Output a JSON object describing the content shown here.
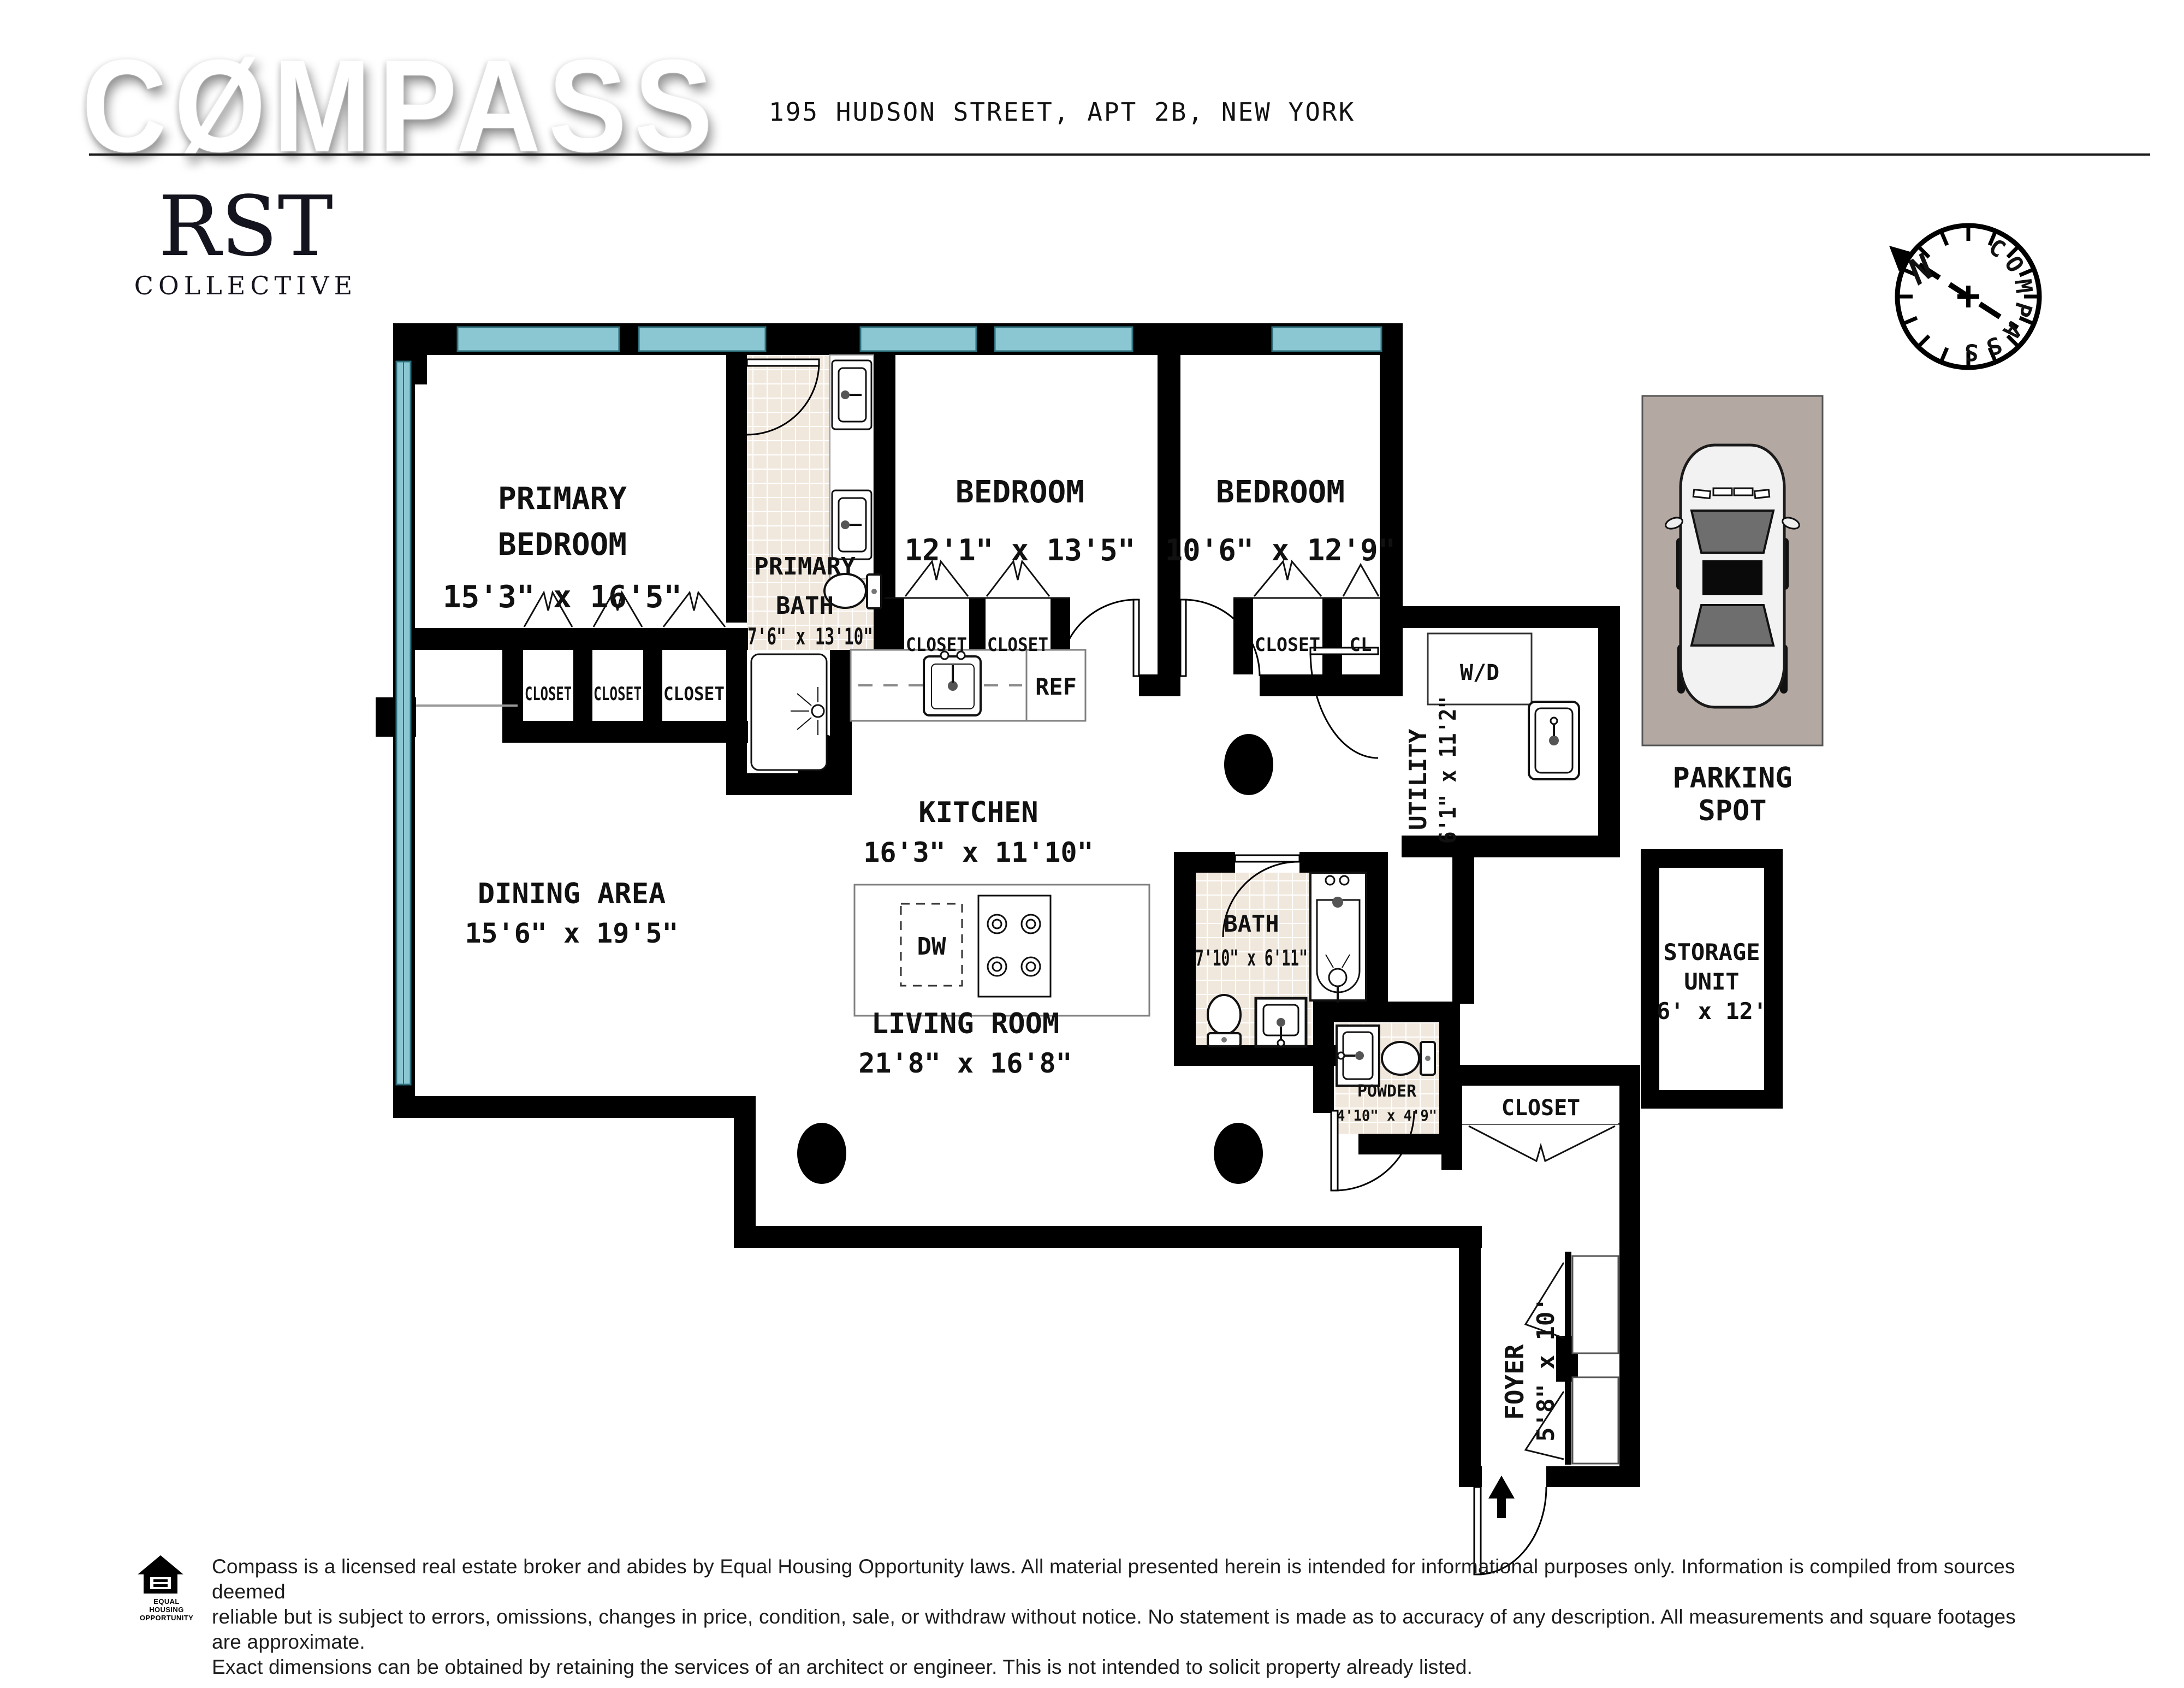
{
  "header": {
    "logo_text": "CØMPASS",
    "address": "195 HUDSON STREET, APT 2B, NEW YORK"
  },
  "brand": {
    "rst": "RST",
    "collective": "COLLECTIVE"
  },
  "compass_rose": {
    "ring_label": "COMPASS",
    "north_label": "N"
  },
  "rooms": {
    "primary_bedroom": {
      "line1": "PRIMARY",
      "line2": "BEDROOM",
      "dims": "15'3\" x 16'5\""
    },
    "primary_bath": {
      "line1": "PRIMARY",
      "line2": "BATH",
      "dims": "7'6\" x 13'10\""
    },
    "bedroom_1": {
      "name": "BEDROOM",
      "dims": "12'1\" x 13'5\""
    },
    "bedroom_2": {
      "name": "BEDROOM",
      "dims": "10'6\" x 12'9\""
    },
    "kitchen": {
      "name": "KITCHEN",
      "dims": "16'3\" x 11'10\""
    },
    "dining_area": {
      "name": "DINING AREA",
      "dims": "15'6\" x 19'5\""
    },
    "living_room": {
      "name": "LIVING ROOM",
      "dims": "21'8\" x 16'8\""
    },
    "bath": {
      "name": "BATH",
      "dims": "7'10\" x 6'11\""
    },
    "powder": {
      "name": "POWDER",
      "dims": "4'10\" x 4'9\""
    },
    "utility": {
      "name": "UTILITY",
      "dims": "6'1\" x 11'2\""
    },
    "foyer": {
      "name": "FOYER",
      "dims": "5'8\" x 10'"
    },
    "storage": {
      "line1": "STORAGE",
      "line2": "UNIT",
      "dims": "6' x 12'"
    },
    "parking": {
      "line1": "PARKING",
      "line2": "SPOT"
    }
  },
  "fixtures": {
    "closet": "CLOSET",
    "cl": "CL",
    "washer_dryer": "W/D",
    "refrigerator": "REF",
    "dishwasher": "DW"
  },
  "footer": {
    "equal_housing_line1": "EQUAL HOUSING",
    "equal_housing_line2": "OPPORTUNITY",
    "disclaimer_line1": "Compass is a licensed real estate broker and abides by Equal Housing Opportunity laws. All material presented herein is intended for informational purposes only. Information is compiled from sources deemed",
    "disclaimer_line2": "reliable but is subject to errors, omissions, changes in price, condition, sale, or withdraw without notice. No statement is made as to accuracy of any description. All measurements and square footages are approximate.",
    "disclaimer_line3": "Exact dimensions can be obtained by retaining the services of an architect or engineer. This is not intended to solicit property already listed."
  },
  "colors": {
    "window_glass": "#8bc7d2",
    "wall": "#000000",
    "tile": "#f1e8dd",
    "parking_ground": "#b3a8a2",
    "north_red": "#e0322a"
  }
}
